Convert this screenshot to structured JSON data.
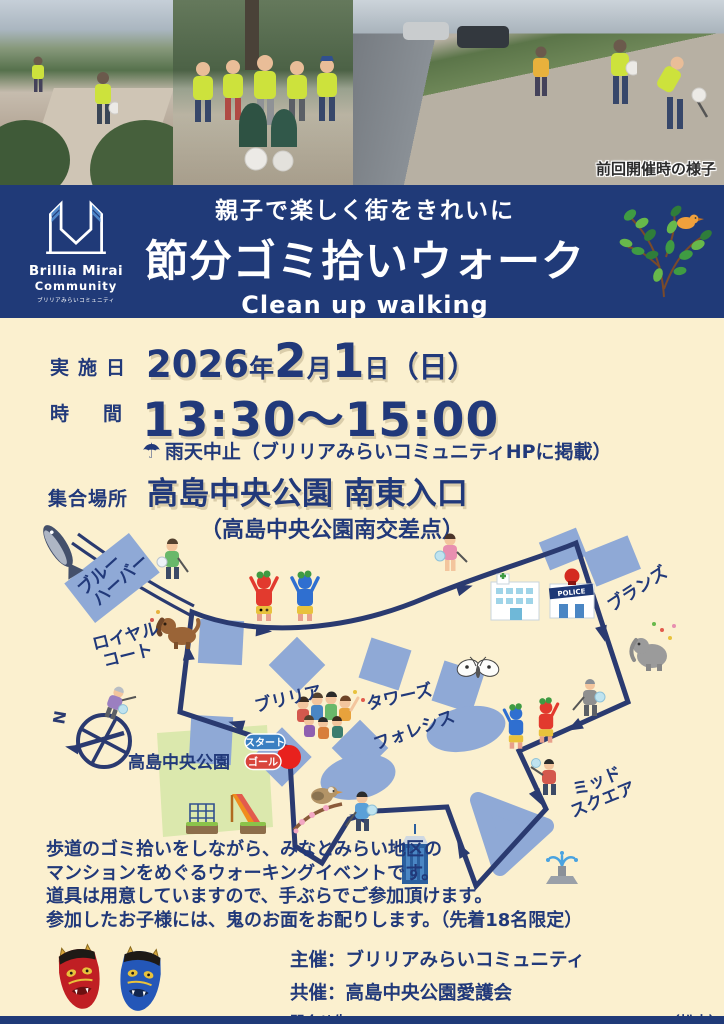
{
  "colors": {
    "navy": "#21397a",
    "banner_navy": "#203a78",
    "cream_background": "#fbf0cf",
    "building_blue": "#8fa9d6",
    "park_green": "#dbe8ad",
    "route_navy": "#2a3a70",
    "start_badge_blue": "#3a7fc2",
    "goal_badge_red": "#d9453c",
    "start_point_red": "#e8211d",
    "vest_yellow_green": "#cde23c"
  },
  "photos": {
    "caption": "前回開催時の様子"
  },
  "banner": {
    "logo": {
      "line1": "Brillia Mirai",
      "line2": "Community",
      "line3": "ブリリアみらいコミュニティ"
    },
    "tagline": "親子で楽しく街をきれいに",
    "title": "節分ゴミ拾いウォーク",
    "subtitle": "Clean up walking"
  },
  "details": {
    "date_label": "実施日",
    "date": {
      "year": "2026",
      "year_suffix": "年",
      "month": "2",
      "month_suffix": "月",
      "day": "1",
      "day_suffix": "日",
      "weekday": "（日）"
    },
    "time_label": "時間",
    "time_value": "13:30～15:00",
    "rain_icon": "☂",
    "rain_note": "雨天中止（ブリリアみらいコミュニティHPに掲載）",
    "place_label": "集合場所",
    "place_value": "高島中央公園 南東入口",
    "place_note": "（高島中央公園南交差点）"
  },
  "map": {
    "labels": {
      "blue_harbor_line1": "ブルー",
      "blue_harbor_line2": "ハーバー",
      "royal_court_line1": "ロイヤル",
      "royal_court_line2": "コート",
      "brillia": "ブリリア",
      "towers": "タワーズ",
      "branz": "ブランズ",
      "foresis": "フォレシス",
      "mid_square_line1": "ミッド",
      "mid_square_line2": "スクエア",
      "park": "高島中央公園",
      "start": "スタート",
      "goal": "ゴール",
      "compass_n": "N",
      "police": "POLICE"
    },
    "icon_names": [
      "tuna-fish-icon",
      "trash-picker-person-icon",
      "dog-icon",
      "red-oni-icon",
      "blue-oni-icon",
      "girl-with-bag-icon",
      "hospital-icon",
      "police-station-icon",
      "elephant-icon",
      "butterfly-icon",
      "elderly-cleaner-icon",
      "crowd-icon",
      "compass-icon",
      "playground-icon",
      "bird-on-branch-icon",
      "skyscraper-icon",
      "fountain-icon",
      "start-point-icon"
    ]
  },
  "description": {
    "line1": "歩道のゴミ拾いをしながら、みなとみらい地区の",
    "line2": "マンションをめぐるウォーキングイベントです。",
    "line3": "道具は用意していますので、手ぶらでご参加頂けます。",
    "line4": "参加したお子様には、鬼のお面をお配りします。（先着18名限定）"
  },
  "footer": {
    "organizer": "主催：ブリリアみらいコミュニティ",
    "co_organizer": "共催：高島中央公園愛護会",
    "contact": "問合せ先：info@brilliamirai.com|090-6036-8101（松本）"
  }
}
